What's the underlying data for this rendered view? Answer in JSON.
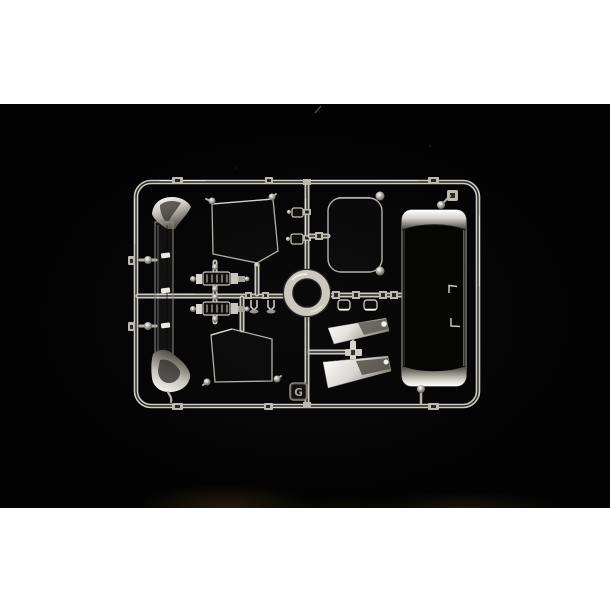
{
  "photo": {
    "alt": "Clear transparent plastic sprue (parts runner) of a scale model kit, with truck cab glazing parts - windshield, side windows, rear window, roof panel, headlight lenses and mirror glasses - photographed on a black background",
    "frame_tag_letter": "G",
    "colors": {
      "page_background": "#ffffff",
      "photo_background": "#050505",
      "sprue_plastic": "#cbc8c0",
      "chrome_highlight": "#f6f5f2",
      "tag_face": "#131110"
    },
    "parts": [
      "windshield-part",
      "side-window-part-upper",
      "side-window-part-lower",
      "rear-window-part",
      "roof-panel-part",
      "headlight-lens-parts",
      "mirror-glass-parts",
      "small-clip-parts"
    ]
  }
}
